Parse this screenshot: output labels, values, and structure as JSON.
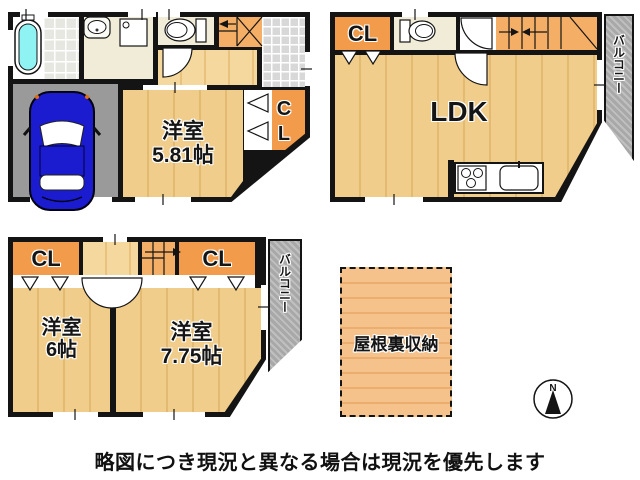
{
  "floor1": {
    "room_label": "洋室",
    "room_size": "5.81帖",
    "closet_label": "CL"
  },
  "floor2": {
    "ldk_label": "LDK",
    "closet_label": "CL",
    "balcony_label": "バルコニー"
  },
  "floor3": {
    "room_left_label": "洋室",
    "room_left_size": "6帖",
    "room_right_label": "洋室",
    "room_right_size": "7.75帖",
    "closet_left_label": "CL",
    "closet_right_label": "CL",
    "balcony_label": "バルコニー"
  },
  "attic": {
    "label": "屋根裏収納"
  },
  "compass": {
    "north_label": "N"
  },
  "footer": {
    "disclaimer": "略図につき現況と異なる場合は現況を優先します"
  },
  "colors": {
    "wall": "#141414",
    "wood_floor": "#F1CD8C",
    "closet_orange": "#F29C4B",
    "stairs_orange": "#F5AE66",
    "balcony_gray": "#A8A8A8",
    "garage_gray": "#9A9A9A",
    "bathtub_cyan": "#8FF3F3",
    "car_blue": "#1B1BD0",
    "attic_orange": "#F6C28B"
  }
}
